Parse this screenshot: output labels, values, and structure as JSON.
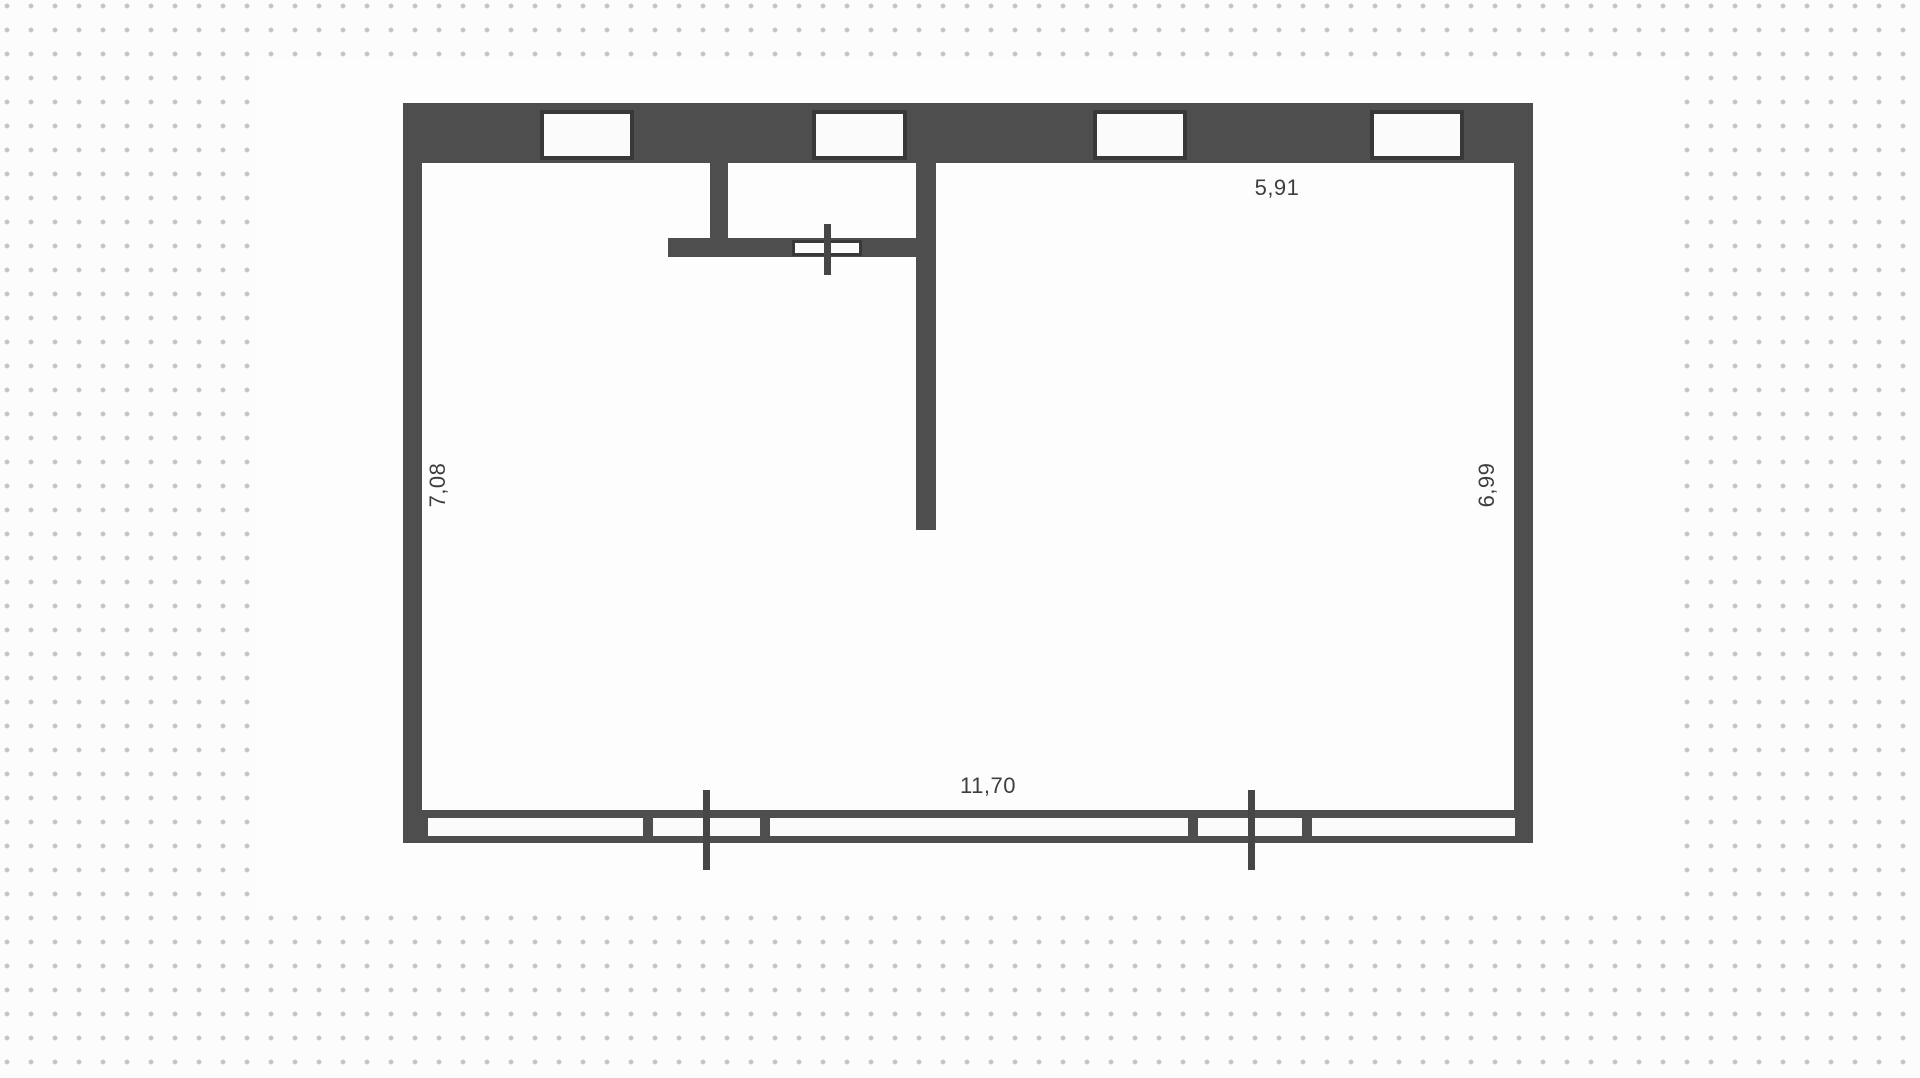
{
  "colors": {
    "background": "#fcfcfc",
    "grid_dot": "#c5c5c5",
    "canvas": "#fdfdfd",
    "wall": "#4e4e4e",
    "window_frame": "#383838",
    "window_fill": "#fbfbfb",
    "label_text": "#3e3e3e"
  },
  "floorplan": {
    "dimension_labels": {
      "top": "5,91",
      "left": "7,08",
      "right": "6,99",
      "bottom": "11,70"
    }
  }
}
